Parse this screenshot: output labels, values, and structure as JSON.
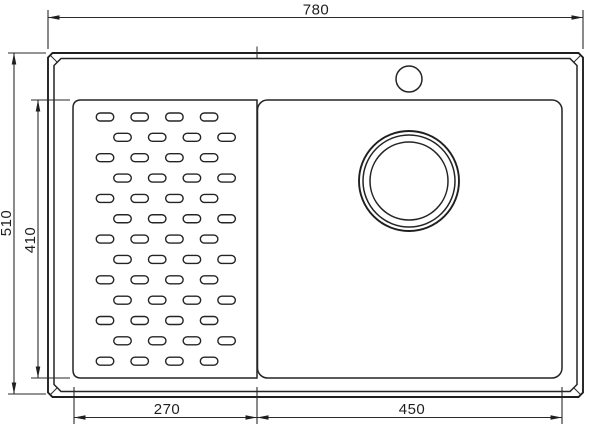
{
  "figure": {
    "name": "sink-technical-drawing",
    "background_color": "#ffffff",
    "line_color": "#1f1f1f"
  },
  "dimensions": {
    "overall_width": "780",
    "overall_height": "510",
    "inner_height": "410",
    "drainboard_width": "270",
    "bowl_width": "450"
  },
  "drainboard_slots": {
    "rows": 13,
    "cols": 4,
    "first_row_center_y": 117,
    "row_pitch": 20.35,
    "odd_row_first_center_x": 105,
    "even_row_first_center_x": 122.5,
    "col_pitch": 34.7,
    "slot_width": 17.5,
    "slot_height": 8
  }
}
